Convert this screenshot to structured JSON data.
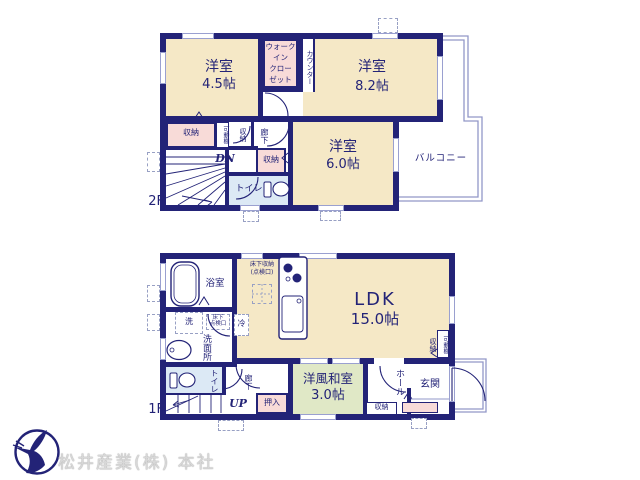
{
  "floor2": {
    "floor_label": "2F",
    "rooms": {
      "bedroom_45": {
        "name": "洋室",
        "size": "4.5帖"
      },
      "wic_lines": [
        "ウォーク",
        "イン",
        "クロー",
        "ゼット"
      ],
      "counter": "カウンター",
      "bedroom_82": {
        "name": "洋室",
        "size": "8.2帖"
      },
      "bedroom_60": {
        "name": "洋室",
        "size": "6.0帖"
      },
      "balcony": "バルコニー",
      "toilet": "トイレ",
      "closet_left": "収納",
      "movable_shelf": "可動棚",
      "closet_small": "収納",
      "hallway": "廊下",
      "closet_mid": "収納",
      "stairs_down": "DN"
    }
  },
  "floor1": {
    "floor_label": "1F",
    "rooms": {
      "ldk": {
        "name": "LDK",
        "size": "15.0帖"
      },
      "bathroom": "浴室",
      "washroom": "洗面所",
      "washer": "洗",
      "fridge": "冷",
      "underfloor_inspection_lines": [
        "床下",
        "点検口"
      ],
      "underfloor_storage_lines": [
        "床下収納",
        "(点検口)"
      ],
      "toilet": "トイレ",
      "hallway": "廊下",
      "stairs_up": "UP",
      "oshiire": "押入",
      "washitsu": {
        "name": "洋風和室",
        "size": "3.0帖"
      },
      "hall": "ホール",
      "entrance": "玄関",
      "closet_hall": "収納",
      "closet_ldk": "収納",
      "movable_shelf": "可動棚"
    }
  },
  "footer": {
    "company": "松井産業(株) 本社"
  },
  "colors": {
    "wall": "#232377",
    "room_cream": "#f5e8c6",
    "closet_pink": "#f8dbd8",
    "toilet_blue": "#dce9f5",
    "tatami_green": "#e0e8c6",
    "thin_line": "#9aa0d0",
    "logo_navy": "#232377",
    "company_gray": "#d8d8d8"
  }
}
